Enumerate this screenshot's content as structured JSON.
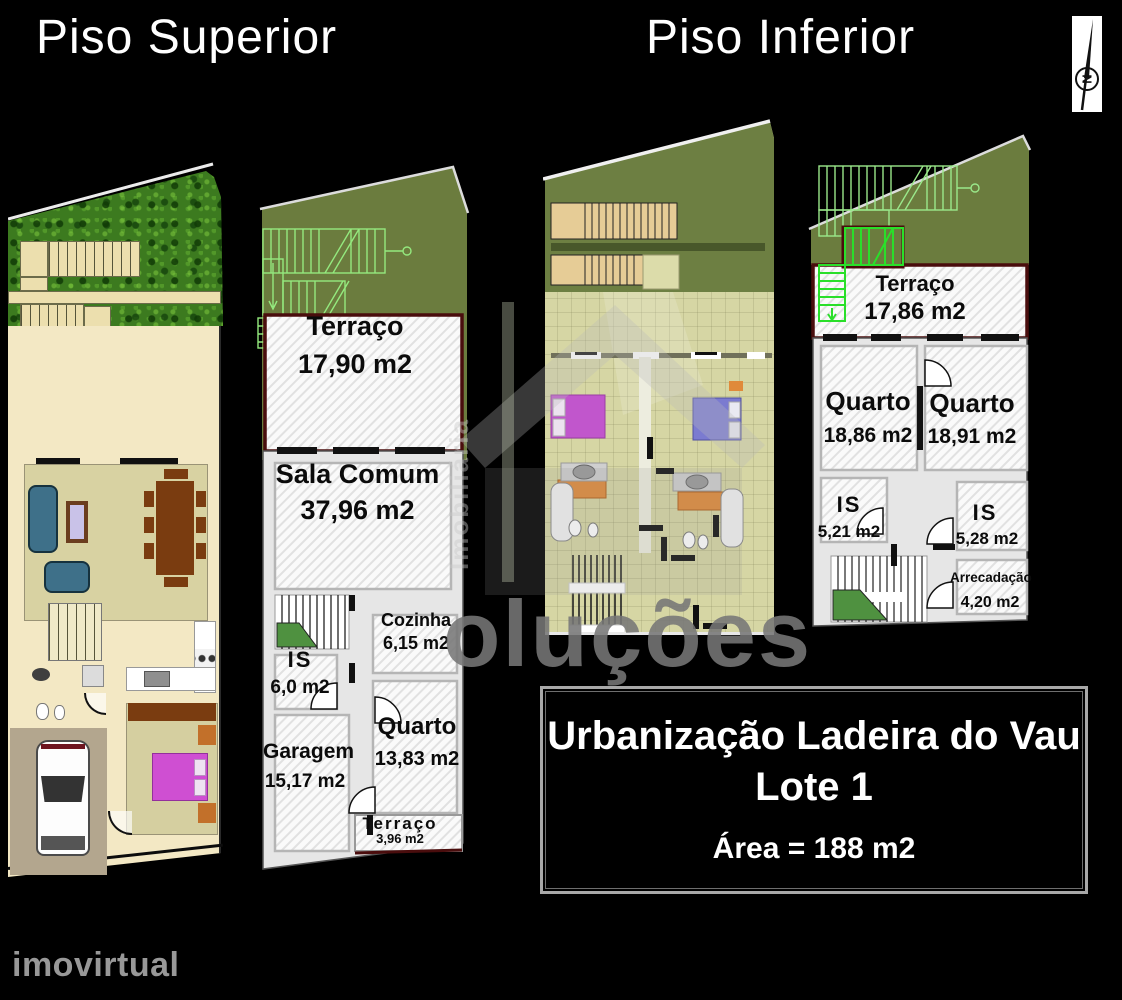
{
  "titles": {
    "superior": "Piso Superior",
    "inferior": "Piso Inferior"
  },
  "compass": {
    "north_label": "N"
  },
  "plans": {
    "superior": {
      "terraco": {
        "name": "Terraço",
        "area": "17,90 m2"
      },
      "sala": {
        "name": "Sala Comum",
        "area": "37,96 m2"
      },
      "cozinha": {
        "name": "Cozinha",
        "area": "6,15 m2"
      },
      "is": {
        "name": "IS",
        "area": "6,0 m2"
      },
      "garagem": {
        "name": "Garagem",
        "area": "15,17 m2"
      },
      "quarto": {
        "name": "Quarto",
        "area": "13,83 m2"
      },
      "terraco_small": {
        "name": "Terraço",
        "area": "3,96 m2"
      }
    },
    "inferior": {
      "terraco": {
        "name": "Terraço",
        "area": "17,86 m2"
      },
      "quarto_left": {
        "name": "Quarto",
        "area": "18,86 m2"
      },
      "quarto_right": {
        "name": "Quarto",
        "area": "18,91 m2"
      },
      "is_left": {
        "name": "IS",
        "area": "5,21 m2"
      },
      "is_right": {
        "name": "IS",
        "area": "5,28 m2"
      },
      "arrecadacao": {
        "name": "Arrecadação",
        "area": "4,20 m2"
      }
    }
  },
  "info_box": {
    "line1": "Urbanização Ladeira do Vau",
    "line2": "Lote 1",
    "area_line": "Área = 188 m2"
  },
  "watermarks": {
    "big": "oluções",
    "vertical": "Imobiliária",
    "brand": "imovirtual"
  },
  "colors": {
    "background": "#000000",
    "terrace_wall": "#4a0d0d",
    "yard_olive": "#6b7c3e",
    "grass_green": "#3c7a1f",
    "plan_cream": "#f3e8c4",
    "bed_magenta": "#cf4fd2",
    "bed_blue": "#7b7bd0",
    "wardrobe_orange": "#e08a3a",
    "stair_green_bright": "#2adf2a",
    "label_text": "#0b0b0b"
  }
}
